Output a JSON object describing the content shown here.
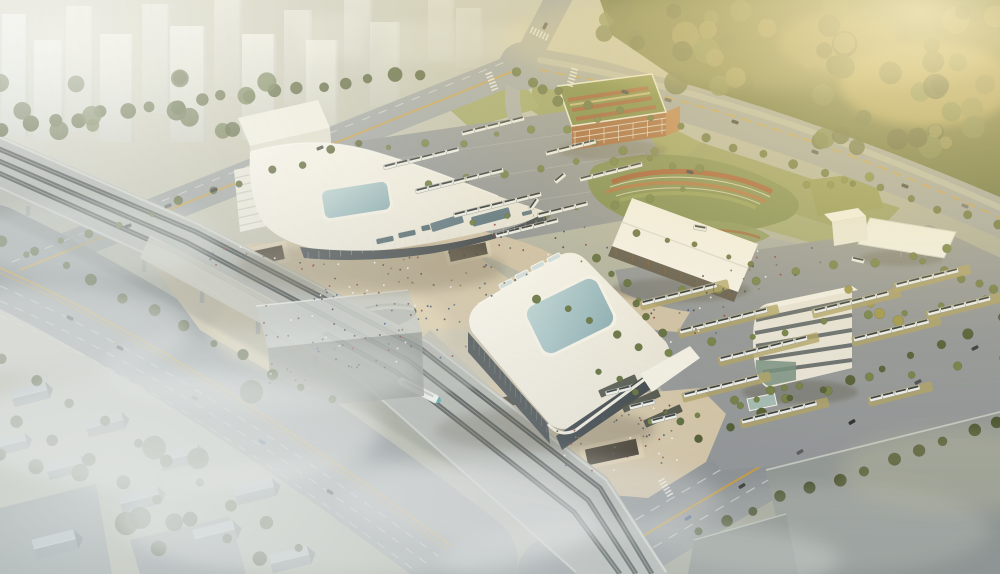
{
  "image": {
    "description": "Aerial architectural rendering of an intermodal transit hub: two white terminal buildings with blue glass skylight roofs, an elevated rail viaduct with a high-speed train, bus parking lots, a striped parking garage, landscaped flower mound, office building, canopy sheds, hazy residential towers and golden forest"
  },
  "palette": {
    "ground": "#b2b2a4",
    "road": "#9aa0a4",
    "road_dark": "#8a9095",
    "lane_white": "#e8eae6",
    "lane_yellow": "#c89a3c",
    "asphalt": "#8e9398",
    "plaza": "#cfc2a8",
    "plaza_lit": "#e4d6b8",
    "roof_white": "#f4f3ee",
    "roof_shade": "#d8d5cb",
    "glass_blue": "#9cc0cb",
    "facade_dark": "#3e464e",
    "tree_green": "#5f6b3a",
    "forest_green": "#5c6638",
    "grass": "#959c60",
    "mound_green": "#79874e",
    "flower_red": "#a1502c",
    "garage_orange": "#a06038",
    "garage_roof": "#74823f",
    "viaduct": "#a8adab",
    "track_dark": "#31383a",
    "warehouse": "#8e9594",
    "house_roof": "#b2bac0",
    "mist": "#e3e8e6",
    "golden_light": "#f2e2a8",
    "train_nose": "#3f9aa0",
    "bus_white": "#eceeec",
    "khaki_strip": "#ab9f63",
    "people_colors": [
      "#3b3b3b",
      "#8a3434",
      "#f2f2f2",
      "#5a5f6a",
      "#2f4a7a",
      "#7a6a4a"
    ]
  },
  "scene": {
    "towers": [
      [
        2,
        14,
        26,
        122,
        0.92
      ],
      [
        34,
        40,
        30,
        100,
        0.88
      ],
      [
        66,
        6,
        28,
        126,
        0.8
      ],
      [
        100,
        34,
        34,
        108,
        0.9
      ],
      [
        142,
        4,
        28,
        110,
        0.66
      ],
      [
        170,
        26,
        36,
        116,
        0.85
      ],
      [
        214,
        0,
        28,
        96,
        0.55
      ],
      [
        242,
        34,
        34,
        106,
        0.8
      ],
      [
        284,
        10,
        28,
        96,
        0.5
      ],
      [
        306,
        40,
        32,
        100,
        0.68
      ],
      [
        344,
        0,
        28,
        76,
        0.42
      ],
      [
        370,
        22,
        30,
        84,
        0.45
      ],
      [
        428,
        0,
        26,
        62,
        0.3
      ],
      [
        456,
        8,
        26,
        60,
        0.26
      ]
    ],
    "hazyBlocks": [
      [
        300,
        14,
        64,
        44,
        0.28
      ],
      [
        386,
        22,
        78,
        40,
        0.22
      ],
      [
        468,
        26,
        58,
        32,
        0.18
      ]
    ],
    "treeRows": [
      {
        "p": [
          5,
          128,
          418,
          72
        ],
        "n": 18,
        "r": 6,
        "c": "#4d5a33",
        "s": 21
      },
      {
        "p": [
          30,
          252,
          360,
          142
        ],
        "n": 12,
        "r": 3.5,
        "c": "#566238",
        "s": 22
      },
      {
        "p": [
          5,
          238,
          330,
          402
        ],
        "n": 12,
        "r": 4.5,
        "c": "#4a5531",
        "s": 23
      },
      {
        "p": [
          5,
          362,
          298,
          546
        ],
        "n": 10,
        "r": 5,
        "c": "#46512f",
        "s": 24
      },
      {
        "p": [
          392,
          150,
          600,
          122
        ],
        "n": 7,
        "r": 3.2,
        "c": "#6d7c44",
        "s": 25
      },
      {
        "p": [
          432,
          186,
          652,
          154
        ],
        "n": 7,
        "r": 3.2,
        "c": "#6d7c44",
        "s": 26
      },
      {
        "p": [
          476,
          224,
          682,
          192
        ],
        "n": 7,
        "r": 3.2,
        "c": "#6d7c44",
        "s": 27
      },
      {
        "p": [
          540,
          300,
          640,
          346
        ],
        "n": 5,
        "r": 3.5,
        "c": "#5d6c3c",
        "s": 28
      },
      {
        "p": [
          602,
          372,
          678,
          422
        ],
        "n": 6,
        "r": 3,
        "c": "#55663a",
        "s": 29
      },
      {
        "p": [
          642,
          300,
          950,
          246
        ],
        "n": 9,
        "r": 3.4,
        "c": "#6d7c44",
        "s": 30
      },
      {
        "p": [
          672,
          352,
          982,
          296
        ],
        "n": 9,
        "r": 3.4,
        "c": "#6d7c44",
        "s": 31
      },
      {
        "p": [
          654,
          420,
          1000,
          356
        ],
        "n": 9,
        "r": 3.4,
        "c": "#6d7c44",
        "s": 32
      },
      {
        "p": [
          600,
          256,
          660,
          330
        ],
        "n": 6,
        "r": 3.4,
        "c": "#5b6a3c",
        "s": 33
      },
      {
        "p": [
          702,
          436,
          1000,
          320
        ],
        "n": 11,
        "r": 4,
        "c": "#4c5831",
        "s": 34
      },
      {
        "p": [
          702,
          528,
          1000,
          420
        ],
        "n": 12,
        "r": 5,
        "c": "#434e2c",
        "s": 35
      },
      {
        "p": [
          562,
          94,
          996,
          224
        ],
        "n": 16,
        "r": 3.6,
        "c": "#5f6b3a",
        "s": 36
      },
      {
        "p": [
          852,
          292,
          898,
          322
        ],
        "n": 4,
        "r": 4.5,
        "c": "#9a9348",
        "s": 37
      },
      {
        "p": [
          738,
          402,
          802,
          384
        ],
        "n": 5,
        "r": 3.4,
        "c": "#6d7a44",
        "s": 38
      },
      {
        "p": [
          810,
          186,
          866,
          177
        ],
        "n": 4,
        "r": 3.6,
        "c": "#77823f",
        "s": 39
      },
      {
        "p": [
          926,
          262,
          995,
          290
        ],
        "n": 5,
        "r": 3.8,
        "c": "#6d7842",
        "s": 40
      },
      {
        "p": [
          520,
          72,
          558,
          100
        ],
        "n": 4,
        "r": 4,
        "c": "#5f6b3a",
        "s": 41
      },
      {
        "p": [
          598,
          142,
          700,
          172
        ],
        "n": 5,
        "r": 3.3,
        "c": "#68763e",
        "s": 42
      },
      {
        "p": [
          640,
          232,
          754,
          262
        ],
        "n": 5,
        "r": 3,
        "c": "#647040",
        "s": 43
      },
      {
        "p": [
          20,
          420,
          258,
          558
        ],
        "n": 8,
        "r": 6,
        "c": "#3f4a2c",
        "s": 44
      }
    ],
    "treePatches": [
      {
        "x": 604,
        "y": 0,
        "w": 398,
        "h": 56,
        "count": 24,
        "rmin": 7,
        "rmax": 14,
        "s": 7,
        "cols": [
          "#55603a",
          "#6b7845",
          "#475230",
          "#83834d"
        ]
      },
      {
        "x": 676,
        "y": 50,
        "w": 326,
        "h": 48,
        "count": 18,
        "rmin": 7,
        "rmax": 13,
        "s": 8,
        "cols": [
          "#55603a",
          "#6b7845",
          "#475230",
          "#83834d"
        ]
      },
      {
        "x": 820,
        "y": 104,
        "w": 182,
        "h": 48,
        "count": 14,
        "rmin": 6,
        "rmax": 12,
        "s": 9,
        "cols": [
          "#55603a",
          "#6b7845",
          "#475230",
          "#83834d"
        ]
      },
      {
        "x": 0,
        "y": 64,
        "w": 330,
        "h": 74,
        "count": 14,
        "rmin": 5,
        "rmax": 10,
        "s": 3,
        "cols": [
          "#4d5a33",
          "#5a6a3e",
          "#42502c"
        ]
      },
      {
        "x": 0,
        "y": 384,
        "w": 276,
        "h": 166,
        "count": 10,
        "rmin": 6,
        "rmax": 12,
        "s": 5,
        "cols": [
          "#3d4830",
          "#4a5636"
        ]
      }
    ],
    "busRows": [
      [
        390,
        166,
        6,
        0
      ],
      [
        422,
        190,
        7,
        0
      ],
      [
        460,
        214,
        7,
        0
      ],
      [
        502,
        234,
        5,
        0
      ],
      [
        468,
        132,
        5,
        0
      ],
      [
        552,
        152,
        4,
        0
      ],
      [
        586,
        178,
        5,
        0
      ],
      [
        544,
        214,
        4,
        0
      ],
      [
        648,
        302,
        6,
        1
      ],
      [
        686,
        330,
        7,
        1
      ],
      [
        726,
        358,
        7,
        1
      ],
      [
        690,
        394,
        6,
        1
      ],
      [
        748,
        420,
        6,
        1
      ],
      [
        820,
        310,
        6,
        1
      ],
      [
        860,
        338,
        6,
        1
      ],
      [
        902,
        284,
        5,
        1
      ],
      [
        934,
        312,
        5,
        1
      ],
      [
        876,
        398,
        4,
        1
      ],
      [
        612,
        392,
        2,
        0
      ],
      [
        636,
        406,
        2,
        0
      ],
      [
        658,
        420,
        2,
        0
      ]
    ],
    "bayCanopies": [
      [
        618,
        386
      ],
      [
        641,
        401
      ],
      [
        663,
        416
      ]
    ],
    "busesOnRoad": [
      [
        560,
        178,
        -40
      ],
      [
        700,
        228,
        10
      ],
      [
        858,
        260,
        13
      ],
      [
        534,
        204,
        -55
      ]
    ],
    "cars": [
      [
        128,
        226,
        -21,
        "#333639"
      ],
      [
        168,
        206,
        -21,
        "#54585c"
      ],
      [
        214,
        190,
        -21,
        "#26292c"
      ],
      [
        320,
        148,
        -22,
        "#45484c"
      ],
      [
        545,
        26,
        -62,
        "#333639"
      ],
      [
        625,
        92,
        16,
        "#333639"
      ],
      [
        668,
        100,
        16,
        "#54585c"
      ],
      [
        735,
        122,
        18,
        "#26292c"
      ],
      [
        815,
        152,
        20,
        "#45484c"
      ],
      [
        905,
        186,
        21,
        "#333639"
      ],
      [
        965,
        206,
        21,
        "#63676b"
      ],
      [
        975,
        348,
        -28,
        "#333639"
      ],
      [
        918,
        382,
        -28,
        "#45484c"
      ],
      [
        852,
        422,
        -30,
        "#26292c"
      ],
      [
        800,
        452,
        -30,
        "#54585c"
      ],
      [
        742,
        486,
        -32,
        "#333639"
      ],
      [
        688,
        518,
        -32,
        "#3a5a8a"
      ],
      [
        70,
        318,
        25,
        "#34383c"
      ],
      [
        120,
        348,
        25,
        "#24282c"
      ],
      [
        195,
        398,
        27,
        "#55595d"
      ],
      [
        262,
        442,
        28,
        "#3a5a8a"
      ],
      [
        330,
        492,
        30,
        "#24282c"
      ],
      [
        80,
        290,
        24,
        "#8a8e90"
      ],
      [
        690,
        172,
        14,
        "#333639"
      ]
    ],
    "people": [
      {
        "x": 255,
        "y": 300,
        "w": 200,
        "h": 90,
        "a": -10,
        "count": 80,
        "s": 11
      },
      {
        "x": 300,
        "y": 262,
        "w": 120,
        "h": 40,
        "a": -8,
        "count": 30,
        "s": 12
      },
      {
        "x": 556,
        "y": 425,
        "w": 120,
        "h": 60,
        "a": -12,
        "count": 40,
        "s": 13
      },
      {
        "x": 445,
        "y": 240,
        "w": 170,
        "h": 70,
        "a": -18,
        "count": 36,
        "s": 14
      },
      {
        "x": 648,
        "y": 300,
        "w": 80,
        "h": 50,
        "a": -14,
        "count": 16,
        "s": 15
      },
      {
        "x": 700,
        "y": 262,
        "w": 120,
        "h": 40,
        "a": -12,
        "count": 18,
        "s": 16
      },
      {
        "x": 208,
        "y": 248,
        "w": 70,
        "h": 26,
        "a": -12,
        "count": 12,
        "s": 17
      }
    ],
    "houses": [
      [
        30,
        395,
        1.0
      ],
      [
        105,
        425,
        1.05
      ],
      [
        180,
        458,
        1.1
      ],
      [
        255,
        492,
        1.1
      ],
      [
        65,
        468,
        1.0
      ],
      [
        140,
        500,
        1.1
      ],
      [
        215,
        535,
        1.15
      ],
      [
        290,
        560,
        1.1
      ],
      [
        10,
        445,
        0.95
      ],
      [
        55,
        545,
        1.2
      ]
    ],
    "piers": [
      [
        28,
        206,
        10
      ],
      [
        86,
        232,
        11
      ],
      [
        144,
        260,
        12
      ],
      [
        202,
        290,
        13
      ],
      [
        258,
        320,
        14
      ],
      [
        316,
        352,
        15
      ],
      [
        374,
        386,
        16
      ],
      [
        430,
        422,
        17
      ],
      [
        486,
        460,
        18
      ],
      [
        540,
        500,
        19
      ],
      [
        592,
        540,
        20
      ]
    ],
    "crosswalks": [
      [
        492,
        82,
        -21
      ],
      [
        540,
        34,
        -64
      ],
      [
        572,
        78,
        17
      ],
      [
        666,
        488,
        -30
      ]
    ],
    "vlines": [
      {
        "a": [
          308,
          252
        ],
        "b": [
          536,
          220
        ],
        "n": 22,
        "len": 9,
        "c": "#cfd4d6",
        "o": 0.4
      },
      {
        "a": [
          474,
          340
        ],
        "b": [
          552,
          428
        ],
        "n": 16,
        "len": 10,
        "c": "#8aa0a8",
        "o": 0.35
      },
      {
        "a": [
          575,
          132
        ],
        "b": [
          662,
          118
        ],
        "n": 7,
        "len": 16,
        "c": "#e8e0d4",
        "o": 0.8
      },
      {
        "a": [
          616,
          248
        ],
        "b": [
          730,
          290
        ],
        "n": 8,
        "len": 8,
        "c": "#7a5a38",
        "o": 0.9
      }
    ]
  }
}
